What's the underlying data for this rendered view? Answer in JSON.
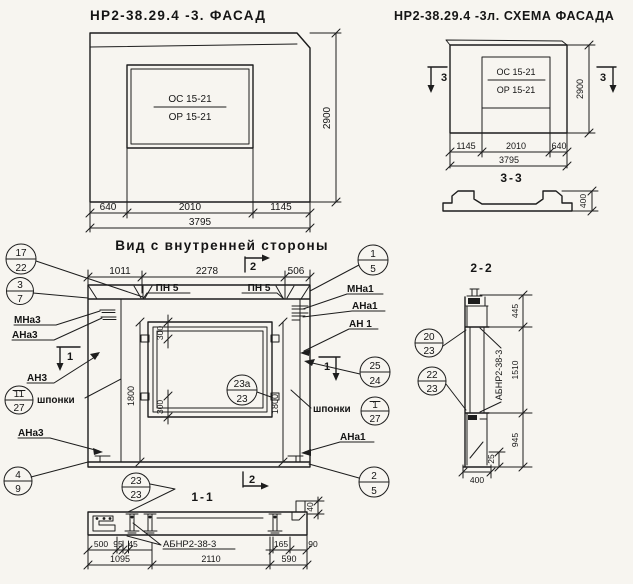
{
  "meta": {
    "paper_color": "#f7f5f0",
    "ink_color": "#1d1d1d"
  },
  "facade": {
    "title": "НР2-38.29.4 -3. ФАСАД",
    "mark_top": "ОС 15-21",
    "mark_bottom": "ОР 15-21",
    "dims": {
      "left": "640",
      "middle": "2010",
      "right": "1145",
      "total": "3795",
      "height": "2900"
    }
  },
  "schema": {
    "title": "НР2-38.29.4 -3л. СХЕМА ФАСАДА",
    "mark_top": "ОС 15-21",
    "mark_bottom": "ОР 15-21",
    "section_marker": "3",
    "dims": {
      "left": "1145",
      "middle": "2010",
      "right": "640",
      "total": "3795",
      "height": "2900"
    },
    "section": {
      "label": "3-3",
      "height": "400"
    }
  },
  "inner_view": {
    "title": "Вид с внутренней стороны",
    "top_dims": {
      "left": "1011",
      "middle": "2278",
      "right": "506"
    },
    "pn_label_1": "ПН 5",
    "pn_label_2": "ПН 5",
    "marker_1": "1",
    "marker_2": "2",
    "window_dims": {
      "top": "300",
      "bottom": "300",
      "left": "1800",
      "right": "1800"
    },
    "left_labels": {
      "mna3": "МНа3",
      "ana3_top": "АНа3",
      "an3": "АН3",
      "shponki": "шпонки",
      "ana3_bottom": "АНа3"
    },
    "right_labels": {
      "mna1": "МНа1",
      "ana1_top": "АНа1",
      "an1": "АН 1",
      "shponki": "шпонки",
      "ana1_bottom": "АНа1"
    },
    "callouts": {
      "c17_22": {
        "top": "17",
        "bottom": "22"
      },
      "c3_7": {
        "top": "3",
        "bottom": "7"
      },
      "c11_27": {
        "top": "11",
        "bottom": "27"
      },
      "c4_9": {
        "top": "4",
        "bottom": "9"
      },
      "c1_5": {
        "top": "1",
        "bottom": "5"
      },
      "c25_24": {
        "top": "25",
        "bottom": "24"
      },
      "c1_27": {
        "top": "1",
        "bottom": "27"
      },
      "c2_5": {
        "top": "2",
        "bottom": "5"
      },
      "c23a_23": {
        "top": "23а",
        "bottom": "23"
      },
      "c23_23": {
        "top": "23",
        "bottom": "23"
      }
    }
  },
  "section_2_2": {
    "label": "2-2",
    "callout_20_23": {
      "top": "20",
      "bottom": "23"
    },
    "callout_22_23": {
      "top": "22",
      "bottom": "23"
    },
    "part_label": "АБНР2-38-3",
    "dims": {
      "top": "445",
      "middle": "1510",
      "bottom": "945",
      "offset": "25",
      "width": "400"
    }
  },
  "section_1_1": {
    "label": "1-1",
    "part_label": "АБНР2-38-3",
    "dims": {
      "d500": "500",
      "d95": "95",
      "d45": "45",
      "d165": "165",
      "d90": "90",
      "d40": "40",
      "d1095": "1095",
      "d2110": "2110",
      "d590": "590"
    }
  }
}
